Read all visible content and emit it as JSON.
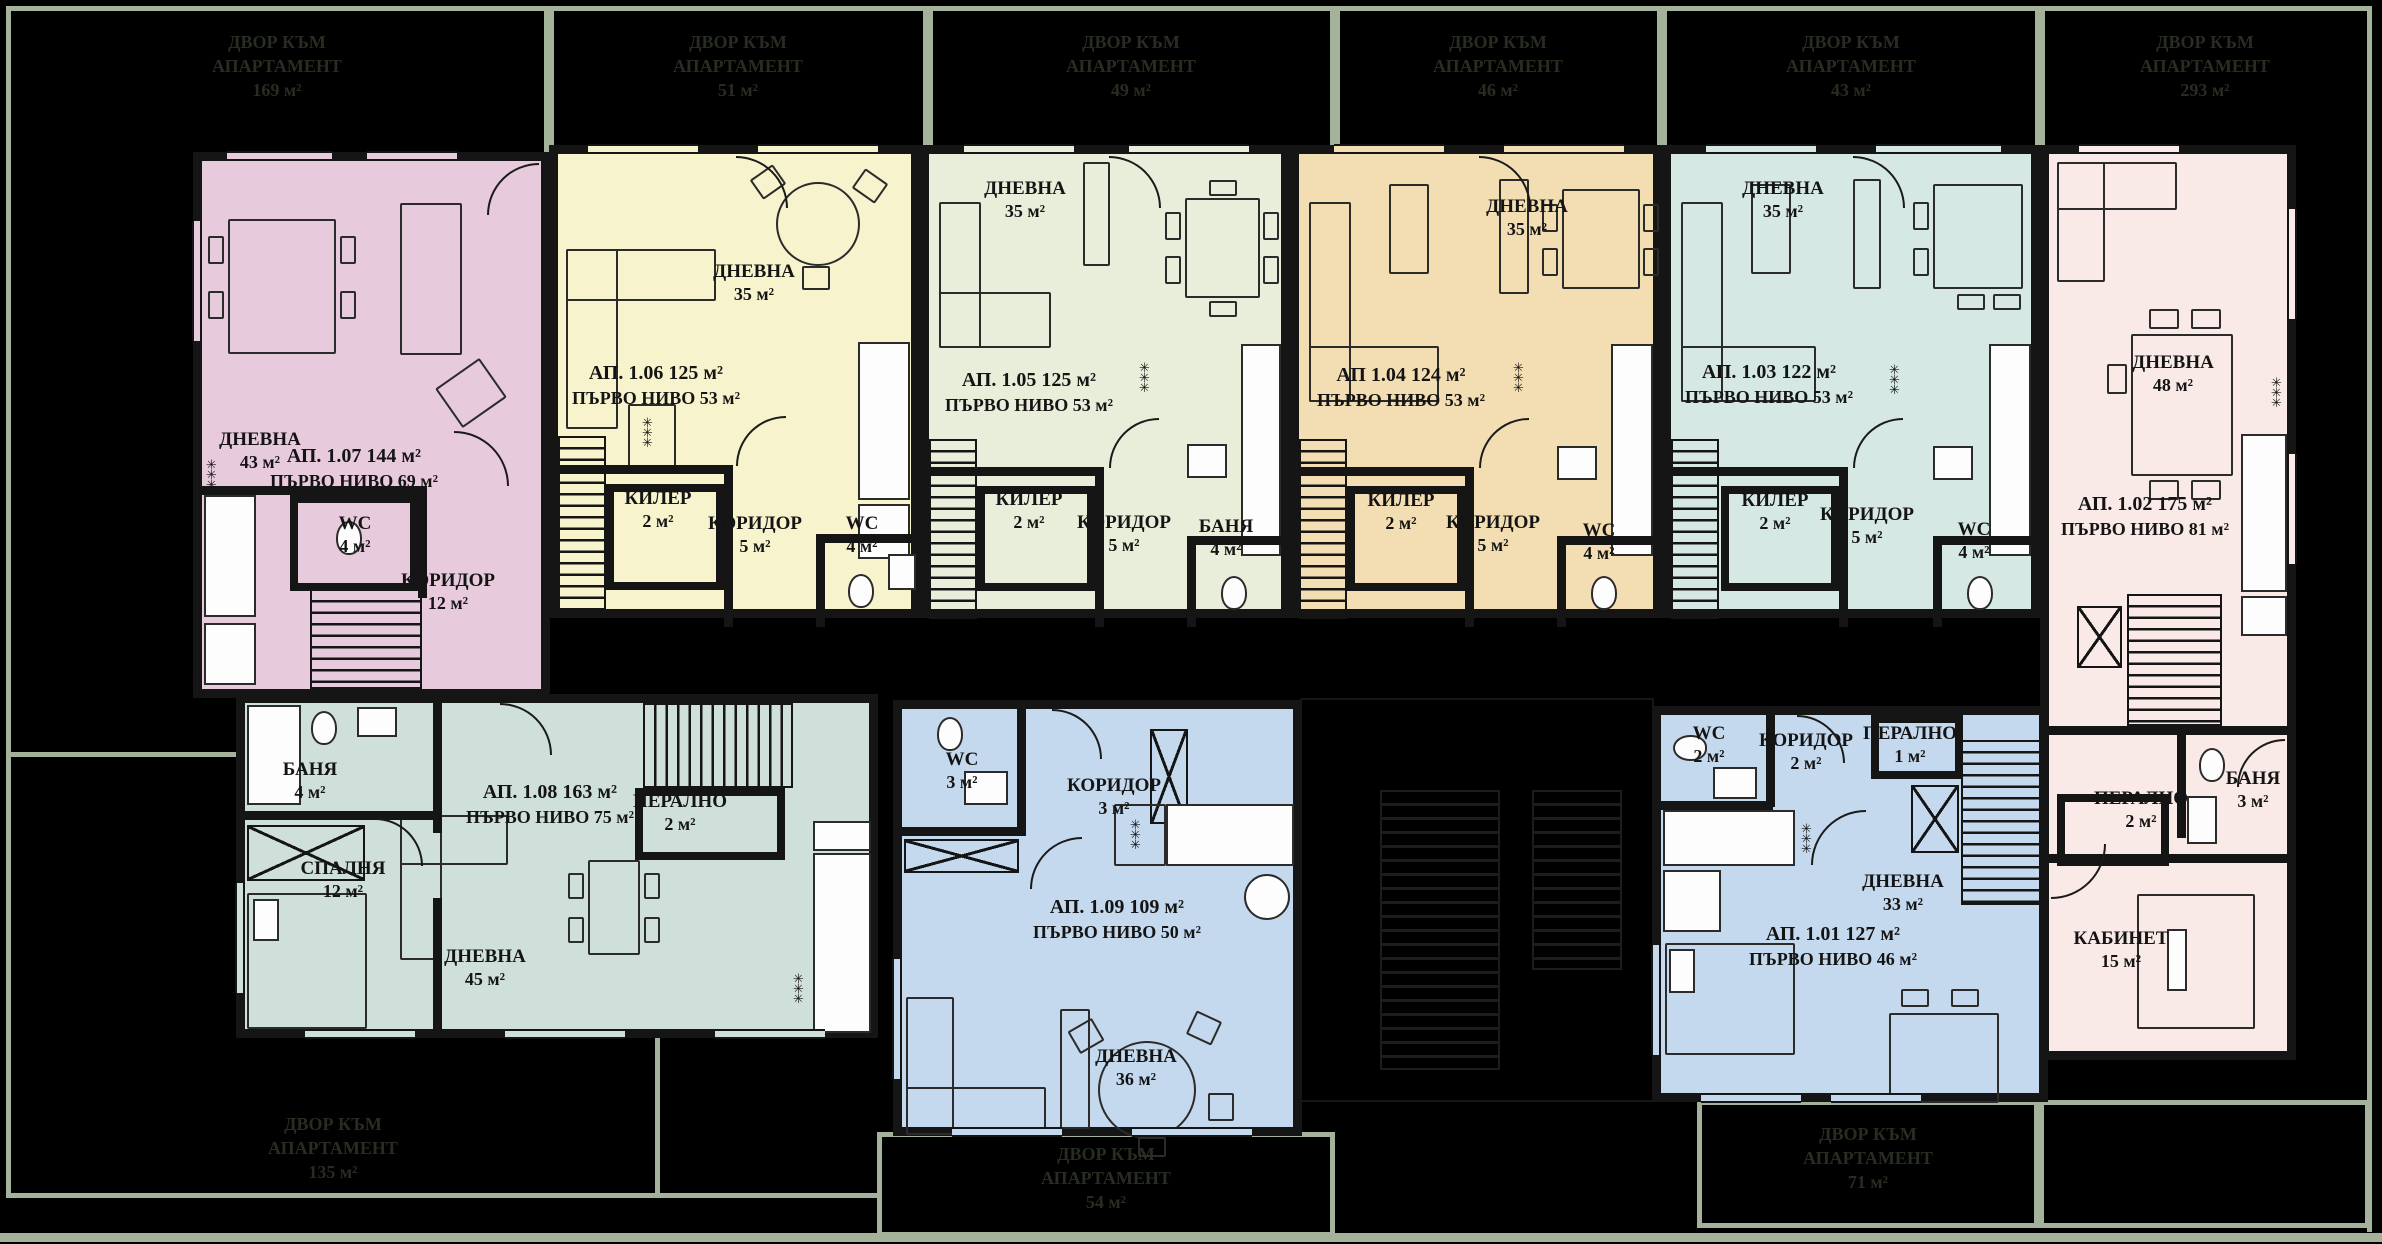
{
  "colors": {
    "background": "#000000",
    "plot_line": "#a5b29b",
    "wall": "#151515",
    "yard_text": "#282d22",
    "ap_107": "#e8cadd",
    "ap_106": "#f7f3cd",
    "ap_105": "#e9eedb",
    "ap_104": "#f3deb3",
    "ap_103": "#d6e8e4",
    "ap_102": "#f9eae8",
    "ap_108": "#cfe0db",
    "ap_109": "#c4d9ee",
    "ap_101": "#c4d9ee"
  },
  "symbols": {
    "radiator": "✳✳✳"
  },
  "yards_top": [
    {
      "line1": "ДВОР КЪМ",
      "line2": "АПАРТАМЕНТ",
      "area": "169 м²"
    },
    {
      "line1": "ДВОР КЪМ",
      "line2": "АПАРТАМЕНТ",
      "area": "51 м²"
    },
    {
      "line1": "ДВОР КЪМ",
      "line2": "АПАРТАМЕНТ",
      "area": "49 м²"
    },
    {
      "line1": "ДВОР КЪМ",
      "line2": "АПАРТАМЕНТ",
      "area": "46 м²"
    },
    {
      "line1": "ДВОР КЪМ",
      "line2": "АПАРТАМЕНТ",
      "area": "43 м²"
    },
    {
      "line1": "ДВОР КЪМ",
      "line2": "АПАРТАМЕНТ",
      "area": "293 м²"
    }
  ],
  "yards_bottom": [
    {
      "line1": "ДВОР КЪМ",
      "line2": "АПАРТАМЕНТ",
      "area": "135 м²"
    },
    {
      "line1": "ДВОР КЪМ",
      "line2": "АПАРТАМЕНТ",
      "area": "54 м²"
    },
    {
      "line1": "ДВОР КЪМ",
      "line2": "АПАРТАМЕНТ",
      "area": "71 м²"
    }
  ],
  "apartments": {
    "a107": {
      "title": "АП. 1.07 144 м²",
      "level": "ПЪРВО НИВО 69 м²",
      "rooms": [
        {
          "name": "ДНЕВНА",
          "area": "43 м²"
        },
        {
          "name": "WC",
          "area": "4 м²"
        },
        {
          "name": "КОРИДОР",
          "area": "12 м²"
        }
      ]
    },
    "a106": {
      "title": "АП. 1.06 125 м²",
      "level": "ПЪРВО НИВО 53 м²",
      "rooms": [
        {
          "name": "ДНЕВНА",
          "area": "35 м²"
        },
        {
          "name": "КИЛЕР",
          "area": "2 м²"
        },
        {
          "name": "КОРИДОР",
          "area": "5 м²"
        },
        {
          "name": "WC",
          "area": "4 м²"
        }
      ]
    },
    "a105": {
      "title": "АП. 1.05 125 м²",
      "level": "ПЪРВО НИВО 53 м²",
      "rooms": [
        {
          "name": "ДНЕВНА",
          "area": "35 м²"
        },
        {
          "name": "КИЛЕР",
          "area": "2 м²"
        },
        {
          "name": "КОРИДОР",
          "area": "5 м²"
        },
        {
          "name": "БАНЯ",
          "area": "4 м²"
        }
      ]
    },
    "a104": {
      "title": "АП 1.04 124 м²",
      "level": "ПЪРВО НИВО 53 м²",
      "rooms": [
        {
          "name": "ДНЕВНА",
          "area": "35 м²"
        },
        {
          "name": "КИЛЕР",
          "area": "2 м²"
        },
        {
          "name": "КОРИДОР",
          "area": "5 м²"
        },
        {
          "name": "WC",
          "area": "4 м²"
        }
      ]
    },
    "a103": {
      "title": "АП. 1.03 122 м²",
      "level": "ПЪРВО НИВО 53 м²",
      "rooms": [
        {
          "name": "ДНЕВНА",
          "area": "35 м²"
        },
        {
          "name": "КИЛЕР",
          "area": "2 м²"
        },
        {
          "name": "КОРИДОР",
          "area": "5 м²"
        },
        {
          "name": "WC",
          "area": "4 м²"
        }
      ]
    },
    "a102": {
      "title": "АП. 1.02 175 м²",
      "level": "ПЪРВО НИВО 81 м²",
      "rooms": [
        {
          "name": "ДНЕВНА",
          "area": "48 м²"
        },
        {
          "name": "ПЕРАЛНО",
          "area": "2 м²"
        },
        {
          "name": "БАНЯ",
          "area": "3 м²"
        },
        {
          "name": "КАБИНЕТ",
          "area": "15 м²"
        }
      ]
    },
    "a108": {
      "title": "АП. 1.08 163 м²",
      "level": "ПЪРВО НИВО 75 м²",
      "rooms": [
        {
          "name": "БАНЯ",
          "area": "4 м²"
        },
        {
          "name": "СПАЛНЯ",
          "area": "12 м²"
        },
        {
          "name": "ПЕРАЛНО",
          "area": "2 м²"
        },
        {
          "name": "ДНЕВНА",
          "area": "45 м²"
        }
      ]
    },
    "a109": {
      "title": "АП. 1.09 109 м²",
      "level": "ПЪРВО НИВО 50 м²",
      "rooms": [
        {
          "name": "WC",
          "area": "3 м²"
        },
        {
          "name": "КОРИДОР",
          "area": "3 м²"
        },
        {
          "name": "ДНЕВНА",
          "area": "36 м²"
        }
      ]
    },
    "a101": {
      "title": "АП. 1.01 127 м²",
      "level": "ПЪРВО НИВО 46 м²",
      "rooms": [
        {
          "name": "WC",
          "area": "2 м²"
        },
        {
          "name": "КОРИДОР",
          "area": "2 м²"
        },
        {
          "name": "ПЕРАЛНО",
          "area": "1 м²"
        },
        {
          "name": "ДНЕВНА",
          "area": "33 м²"
        }
      ]
    }
  }
}
